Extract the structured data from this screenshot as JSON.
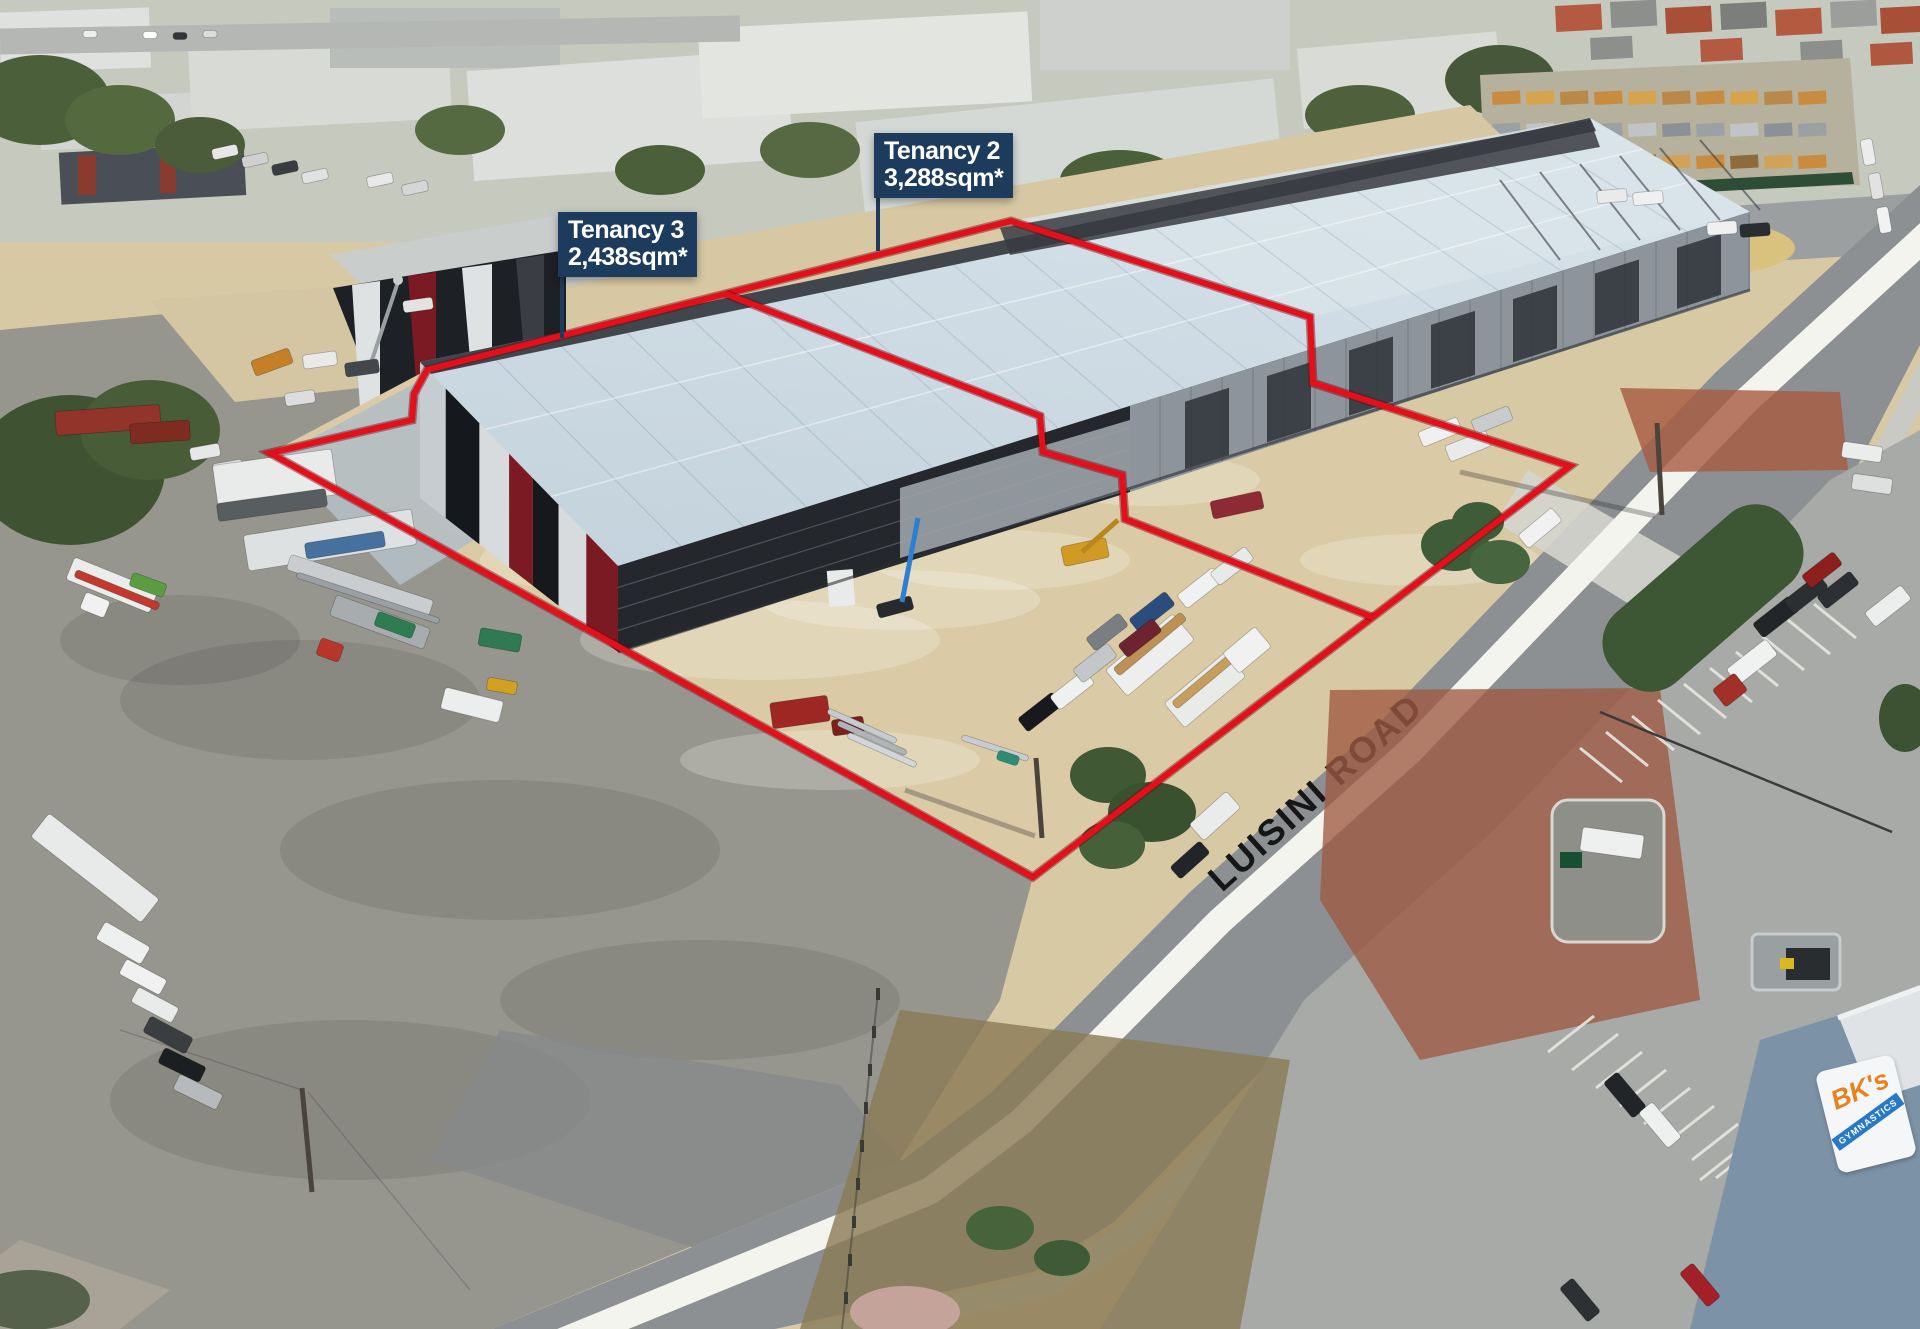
{
  "annotations": {
    "tenancy2": {
      "title": "Tenancy 2",
      "area": "3,288sqm*"
    },
    "tenancy3": {
      "title": "Tenancy 3",
      "area": "2,438sqm*"
    },
    "road_label": "LUISINI ROAD"
  },
  "signage": {
    "bks_logo_top": "BK's",
    "bks_logo_band": "GYMNASTICS"
  },
  "colors": {
    "boundary_red": "#e2101b",
    "label_navy": "#1d3b5c",
    "warehouse_roof": "#ccd9e2",
    "road_edge_band_white": "#f4f4ef",
    "asphalt_grey": "#8c9092",
    "sand_ground": "#d8c9a5"
  }
}
